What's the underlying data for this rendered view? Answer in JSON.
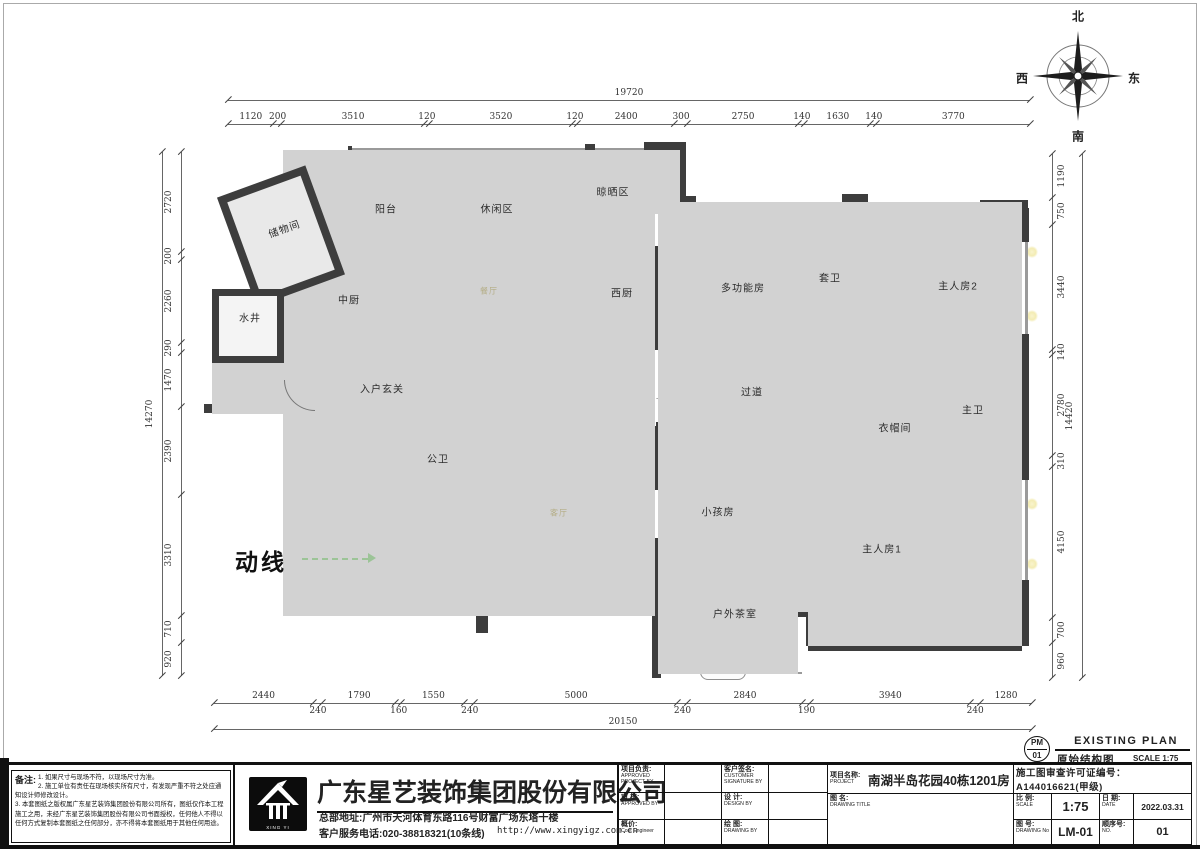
{
  "compass": {
    "north": "北",
    "south": "南",
    "east": "东",
    "west": "西"
  },
  "plan": {
    "rooms": [
      {
        "label": "储物间"
      },
      {
        "label": "阳台"
      },
      {
        "label": "休闲区"
      },
      {
        "label": "晾晒区"
      },
      {
        "label": "水井"
      },
      {
        "label": "中厨"
      },
      {
        "label": "西厨"
      },
      {
        "label": "餐厅"
      },
      {
        "label": "多功能房"
      },
      {
        "label": "套卫"
      },
      {
        "label": "主人房2"
      },
      {
        "label": "入户玄关"
      },
      {
        "label": "过道"
      },
      {
        "label": "衣帽间"
      },
      {
        "label": "主卫"
      },
      {
        "label": "公卫"
      },
      {
        "label": "客厅"
      },
      {
        "label": "小孩房"
      },
      {
        "label": "主人房1"
      },
      {
        "label": "户外茶室"
      }
    ],
    "flow_label": "动线"
  },
  "dims": {
    "top_total": [
      "19720"
    ],
    "top": [
      "1120",
      "200",
      "3510",
      "120",
      "3520",
      "120",
      "2400",
      "300",
      "2750",
      "140",
      "1630",
      "140",
      "3770"
    ],
    "left_total": [
      "14270"
    ],
    "left": [
      "2720",
      "200",
      "2260",
      "290",
      "1470",
      "2390",
      "3310",
      "710",
      "920"
    ],
    "right": [
      "1190",
      "750",
      "3440",
      "140",
      "2780",
      "310",
      "4150",
      "700",
      "960"
    ],
    "right_total": [
      "14420"
    ],
    "bottom": [
      "2440",
      "240",
      "1790",
      "160",
      "1550",
      "240",
      "5000",
      "240",
      "2840",
      "190",
      "3940",
      "240",
      "1280"
    ],
    "bottom_total": [
      "20150"
    ]
  },
  "stamp": {
    "code_top": "PM",
    "code_bottom": "01",
    "title_en": "EXISTING PLAN",
    "title_cn": "原始结构图",
    "scale": "SCALE 1:75"
  },
  "titleblock": {
    "notes_label": "备注:",
    "notes": [
      "1. 如果尺寸与现场不符，以现场尺寸为准。",
      "2. 施工单位有责任在现场核实所有尺寸，有发现严重不符之处应通知设计师修改设计。",
      "3. 本套图纸之版权属广东星艺装饰集团股份有限公司所有，图纸仅作本工程施工之用，未经广东星艺装饰集团股份有限公司书面授权，任何他人不得以任何方式复制本套图纸之任何部分，亦不得将本套图纸用于其他任何用途。"
    ],
    "company": {
      "name": "广东星艺装饰集团股份有限公司",
      "address": "总部地址:广州市天河体育东路116号财富广场东塔十楼",
      "phone": "客户服务电话:020-38818321(10条线)",
      "website": "http://www.xingyigz.com.cn",
      "logo_text": "XING YI"
    },
    "fields": {
      "pm_label": "项目负责:",
      "pm_en": "APPROVED PROJECT BY",
      "customer_label": "客户签名:",
      "customer_en": "CUSTOMER SIGNATURE BY",
      "audit_label": "审 核:",
      "audit_en": "APPROVED BY",
      "design_label": "设 计:",
      "design_en": "DESIGN BY",
      "cost_label": "概价:",
      "cost_en": "Cost Engineer",
      "draw_label": "绘 图:",
      "draw_en": "DRAWING BY",
      "project_label": "项目名称:",
      "project_en": "PROJECT",
      "project_value": "南湖半岛花园40栋1201房",
      "permit": "施工图审查许可证编号：A144016621(甲级)",
      "dwgtitle_label": "图 名:",
      "dwgtitle_en": "DRAWING TITLE",
      "scale_label": "比 例:",
      "scale_en": "SCALE",
      "scale_value": "1:75",
      "date_label": "日 期:",
      "date_en": "DATE",
      "date_value": "2022.03.31",
      "dwgno_label": "图 号:",
      "dwgno_en": "DRAWING No",
      "dwgno_value": "LM-01",
      "seq_label": "顺序号:",
      "seq_en": "NO.",
      "seq_value": "01"
    }
  }
}
